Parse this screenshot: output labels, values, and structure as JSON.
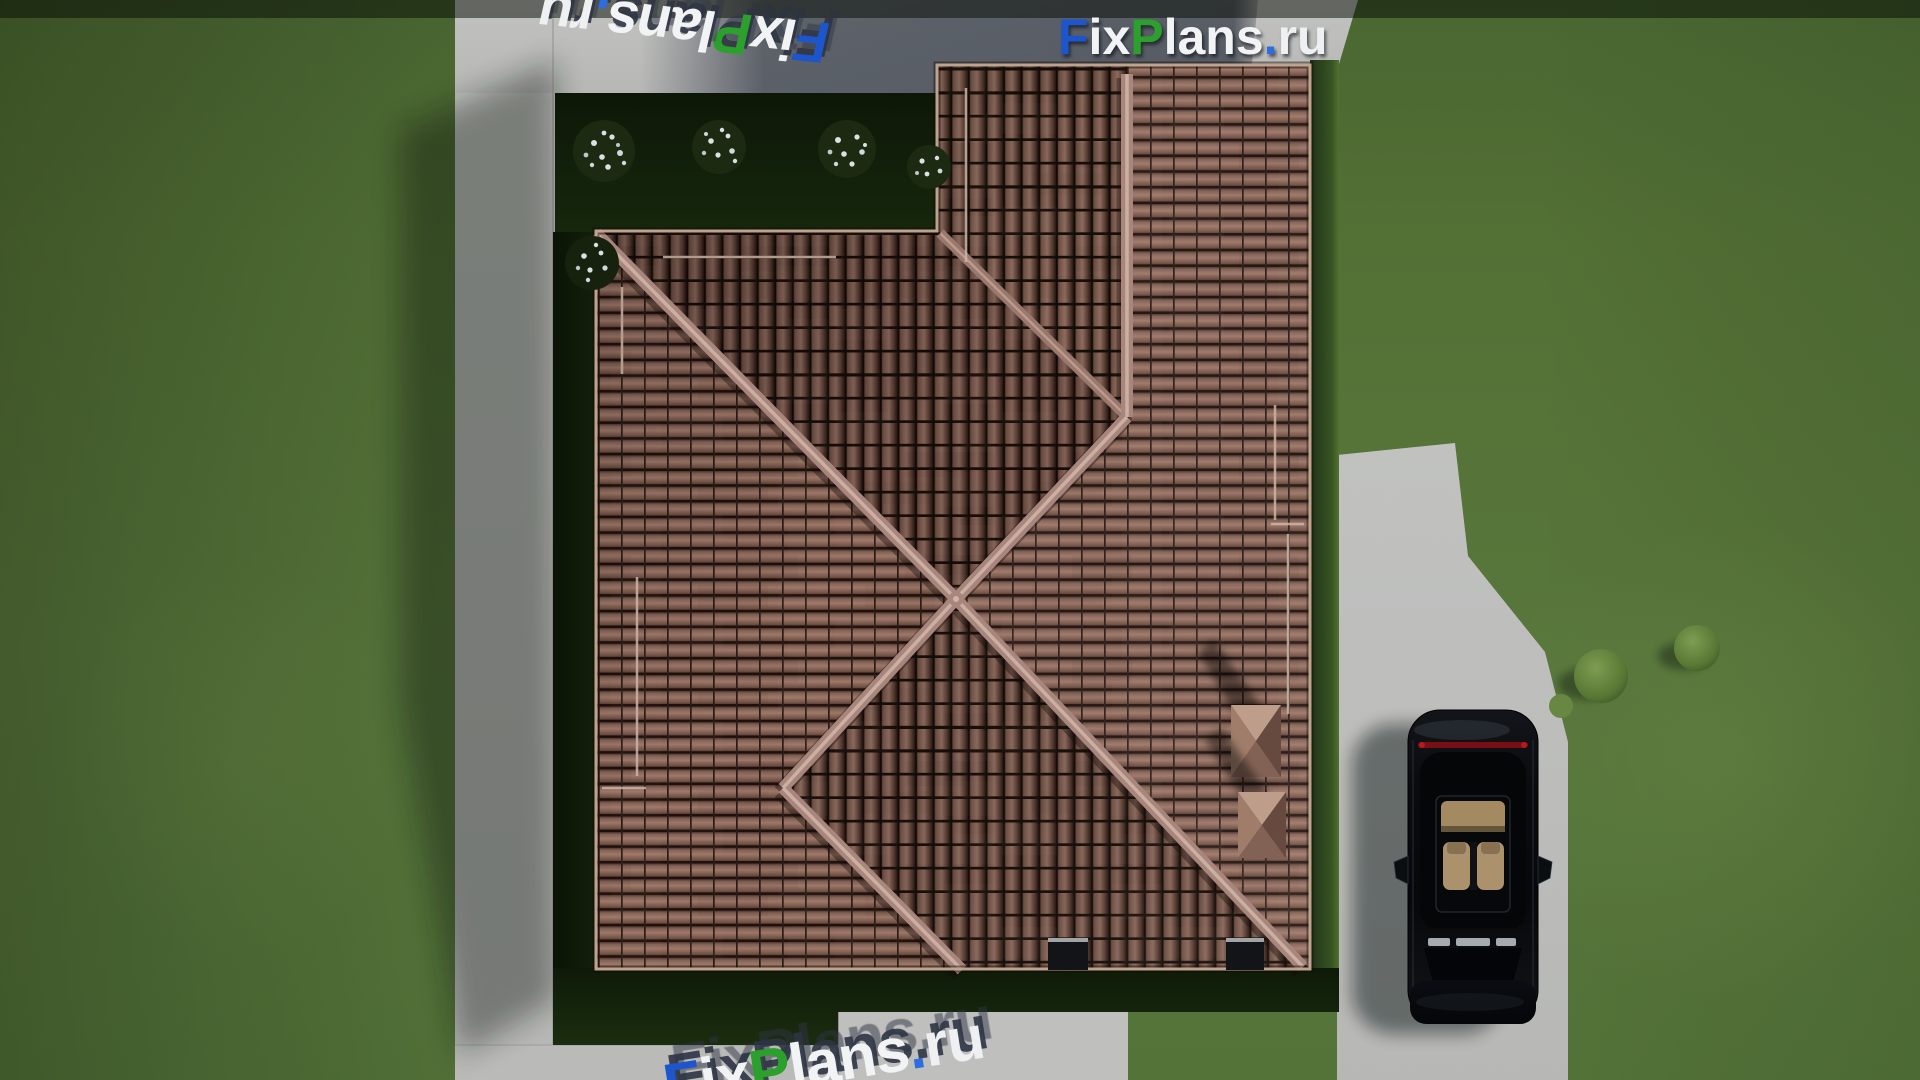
{
  "brand": {
    "name": "FixPlans.ru",
    "letters": [
      {
        "text": "F",
        "color": "#1d55cc"
      },
      {
        "text": "ix",
        "color": "#f2f3f5"
      },
      {
        "text": "P",
        "color": "#2ca02c"
      },
      {
        "text": "lans",
        "color": "#f2f3f5"
      },
      {
        "text": ".",
        "color": "#2d6de0"
      },
      {
        "text": "ru",
        "color": "#eef0f2"
      }
    ]
  },
  "watermarks": {
    "top_left": {
      "text": "FixPlans.ru",
      "style": "3d-extruded",
      "rotation_deg": 186
    },
    "top_right": {
      "text": "FixPlans.ru",
      "style": "flat-logo",
      "rotation_deg": 0
    },
    "bottom": {
      "text": "FixPlans.ru",
      "style": "3d-extruded",
      "rotation_deg": -9,
      "clipped": "bottom-edge"
    }
  },
  "scene": {
    "view": "top-down 3D render of a house roof plan",
    "objects": [
      "hip-roof",
      "roof-valley",
      "roof-ridges",
      "chimney-1",
      "chimney-2",
      "roof-vent-1",
      "roof-vent-2",
      "flower-bushes",
      "garden-bed",
      "lawn",
      "concrete-paths",
      "driveway",
      "black-car",
      "walkway",
      "shrubs"
    ],
    "palette": {
      "roof_tile": "#96705f",
      "roof_tile_dark": "#3c261d",
      "roof_ridge": "#b28e85",
      "roof_valley": "#a27f75",
      "lawn": "#5d7c40",
      "lawn_shadow": "#15240d",
      "concrete": "#c9cac8",
      "concrete_shadow": "#4e5560",
      "car_body": "#0b0d10",
      "car_interior": "#b59b73",
      "tail_light": "#8a1016",
      "flowers": "#e9edef"
    }
  }
}
